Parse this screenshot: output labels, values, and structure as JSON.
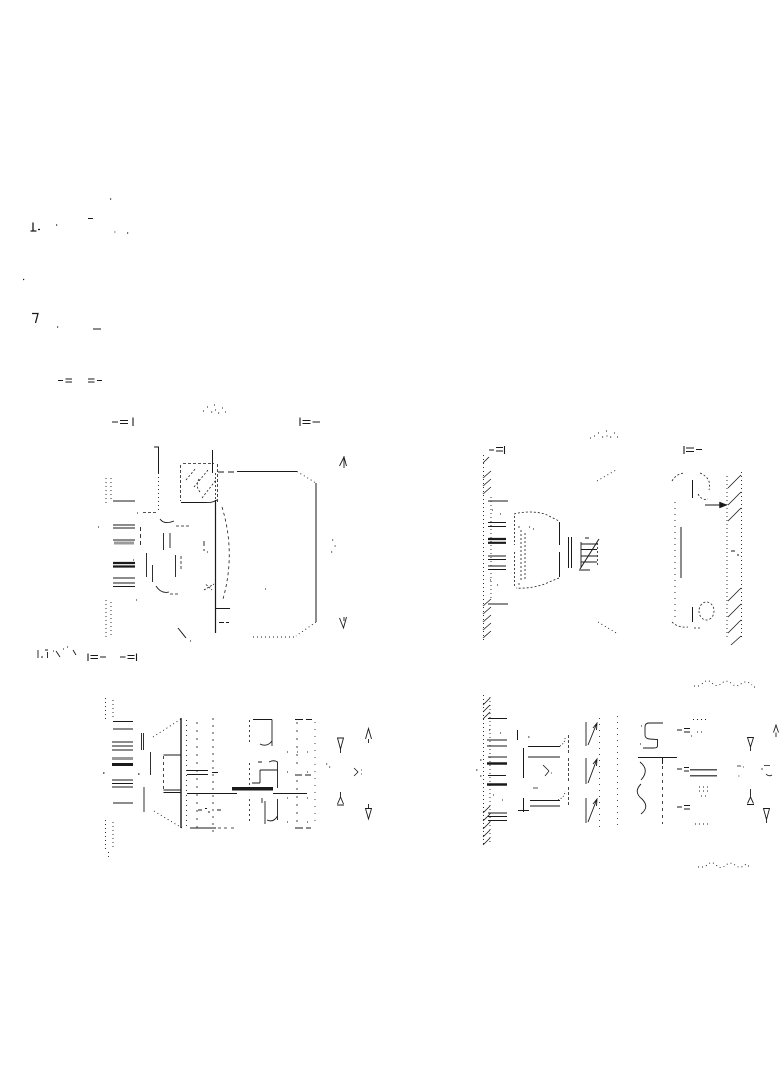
{
  "page": {
    "background": "#ffffff",
    "ink": "#1a1a1a",
    "accent_gray": "#9a9a9a"
  },
  "views": [
    {
      "id": "view-a",
      "position": "upper-left",
      "kind": "section-view",
      "label_text_legible": false,
      "marker_left_glyph": "-=|",
      "marker_right_glyph": "|=-"
    },
    {
      "id": "view-b",
      "position": "upper-right",
      "kind": "section-view",
      "label_text_legible": false,
      "marker_left_glyph": "-=|",
      "marker_right_glyph": "|=-"
    },
    {
      "id": "view-c",
      "position": "lower-left",
      "kind": "section-view",
      "marker_left_glyph": "|=-",
      "marker_right_glyph": "-=|"
    },
    {
      "id": "view-d",
      "position": "lower-right",
      "kind": "section-view"
    }
  ],
  "drawing": {
    "ink": "#1a1a1a",
    "groups": [
      {
        "name": "margin-marks",
        "strokes": [
          {
            "d": "M33 222.5 V231 M30.5 231 H36.5 M32 313.5 H38 L35.5 323",
            "w": 1.3
          },
          {
            "d": "M56 225 h1.2 M110 199 h1.2 M23 279.5 h1.2 M57 327 h1.2 M127 233 h1.2 M38 229.5 h2",
            "w": 1.2
          },
          {
            "d": "M88 218.5 H93 M93 329 H101",
            "w": 1
          },
          {
            "d": "M114 232 h1.5",
            "w": 1.4,
            "c": "#9a9a9a"
          },
          {
            "d": "M58 380.5 H63 M65.5 379 H72 M65.5 382 H72 M88 379 H94.5 M88 382 H94.5 M97 380.5 H102",
            "w": 1.1
          }
        ]
      },
      {
        "name": "view-a-label",
        "strokes": [
          {
            "d": "M203 411 h1 M207 407 h1 M211 412 h1.2 M214 405 h1 M215 410 h1 M218 413 h1.2 M222 408 h1 M225 412 h1",
            "w": 1.1
          }
        ]
      },
      {
        "name": "view-a-markers",
        "strokes": [
          {
            "d": "M112 422 H118 M120 420.5 H128 M120 423.5 H128 M133 417.5 V426",
            "w": 1.1
          },
          {
            "d": "M300 417.5 V426 M302.5 420.5 H310.5 M302.5 423.5 H310.5 M312.5 422 H320",
            "w": 1.1
          }
        ]
      },
      {
        "name": "view-a-body",
        "strokes": [
          {
            "d": "M106 478 V505 M111 478 V502 M106 600 V640 M111 602 V638",
            "dash": "1 3",
            "w": 0.9
          },
          {
            "d": "M113 501 H135 M113 525 H135 M113 528 H135 M113 540 H135 M113 578 H135 M113 583 H135 M113 586.5 H135",
            "w": 1
          },
          {
            "d": "M114 543 H134",
            "w": 3,
            "c": "#9a9a9a"
          },
          {
            "d": "M113 563 H135 M113 566.5 H135",
            "w": 2.2
          },
          {
            "d": "M140.5 527 V547",
            "dash": "4 3",
            "w": 0.9
          },
          {
            "d": "M158.5 447 V473 M154 447 H159 M212.5 450 V473",
            "w": 1
          },
          {
            "d": "M158.5 473 V510",
            "dash": "1 3",
            "w": 0.9
          },
          {
            "d": "M143 512.5 H158 M176 526 H189 M170 594 H178 M181 556 V570",
            "dash": "3 2",
            "w": 0.8
          },
          {
            "d": "M160 519 Q164 525 174 521 M156 586 Q161 594 169 592",
            "w": 0.9
          },
          {
            "d": "M163.5 533 V550 M170 533 V548 M175.5 555 V577 M146.5 553 V577 M152.5 565 V582",
            "w": 0.9
          },
          {
            "d": "M183 463.5 H214 M180.5 465 V501 M217.5 464 V502",
            "dash": "3 2",
            "w": 0.8
          },
          {
            "d": "M181 502.5 H206 M206 502.5 Q212 503 217 500",
            "w": 0.9
          },
          {
            "d": "M186 480 L196 468 M194 487 L208 470 M202 498 L216 480 M199 479 Q195 486 200 492",
            "dash": "2 2",
            "w": 0.8
          },
          {
            "d": "M215.5 473 V500",
            "dash": "2 2",
            "w": 0.8
          },
          {
            "d": "M215.5 500 V633",
            "w": 1.2
          },
          {
            "d": "M222 507 Q236 553 223 599",
            "dash": "3 3",
            "w": 0.8
          },
          {
            "d": "M204 541 v5 M204 549 v2 M207 552 h1",
            "w": 0.9
          },
          {
            "d": "M204 590 L214 584 M206 584.5 L212 590",
            "dash": "2 1.5",
            "w": 0.8
          },
          {
            "d": "M215 608.5 H230 M178 628 L186 638",
            "w": 1
          },
          {
            "d": "M219 622.5 H224 M226 622.5 H229 M218 472 H224 M228 472 H234",
            "w": 0.9
          },
          {
            "d": "M237 471.5 H297 M316 483 V622",
            "w": 1
          },
          {
            "d": "M297 471.5 L316 483 M316 622 L296 636 M294 637 H253",
            "dash": "1 3",
            "w": 0.9
          },
          {
            "d": "M137 513 h1 M133 560 h1 M136 600 h1 M98 527 h1 M190 641 h1 M265 589 h1",
            "w": 1.1
          },
          {
            "d": "M332 540 h1.2 M334.5 546 h1.2 M331 552 h1.2",
            "w": 1.1
          },
          {
            "d": "M344 456 V468 M339.5 466 L344 457 L346.5 466",
            "w": 0.9
          },
          {
            "d": "M344 617 V621 M339.5 618 L343.5 628 L346.5 617",
            "w": 0.9
          }
        ]
      },
      {
        "name": "view-b-label",
        "strokes": [
          {
            "d": "M590 438 h1 M594 436 h1 M598 433 h1 M602 437 h1.2 M606 431 h1 M606.5 436 h1 M610 437 h1.2 M614 433 h1 M617 437 h1",
            "w": 1.1
          }
        ]
      },
      {
        "name": "view-b-markers",
        "strokes": [
          {
            "d": "M489 450 H494 M496 447.5 H503 M496 451 H503 M504.5 446 V454",
            "w": 1.1
          },
          {
            "d": "M684 446 V454 M686 448 H694 M686 451.5 H694 M696 449.5 H702",
            "w": 1.1
          }
        ]
      },
      {
        "name": "view-b-body",
        "strokes": [
          {
            "d": "M483.5 455 V642 M491 497 V598",
            "dash": "1 3",
            "w": 0.9
          },
          {
            "d": "M483 463 L489 457 M483 478 L491 471 M483 486 L491 479 M483 494 L491 487 M483 606 L491 599 M483 614 L491 607 M483 622 L491 615 M483 630 L491 623 M483 638 L491 631",
            "w": 0.8
          },
          {
            "d": "M488 501 H508 M488 604 H508",
            "w": 1
          },
          {
            "d": "M488 522.5 H506 M488 526.5 H506 M488 556 H506 M488 559.5 H506 M488 566 H506 M488 569.5 H506",
            "w": 1
          },
          {
            "d": "M488 539 H506 M488 542.8 H506",
            "w": 2.2
          },
          {
            "d": "M490 580 h1 M497 585 h1 M492 510 h1 M500 514 h1 M529 527 h1 M533 529 h1",
            "w": 1.1
          },
          {
            "d": "M514 514 Q530 510 545 514 L559 521 M559 578 L542 585 Q527 589 516 588 M514.5 516 V545 M514.5 552 V586 M521 530 V582 M525 533 V579 M518 527 H522 M518 584 H522",
            "dash": "2 2",
            "w": 0.8
          },
          {
            "d": "M559.5 522 V545 M559.5 552 V577 M568.5 537 V568 M571.5 537 V568",
            "w": 1
          },
          {
            "d": "M581 544 H597 M581 549.5 H597 M581 556 H597 M581 562 H597 M581 542 V568 M579 570 H590 M585 538 H589",
            "w": 0.9
          },
          {
            "d": "M597.5 543 V566",
            "dash": "2 2",
            "w": 0.8
          },
          {
            "d": "M580 569 L599 539",
            "w": 1
          },
          {
            "d": "M597 481 L616 470 M598 622 L618 634",
            "dash": "1 3",
            "w": 0.9
          },
          {
            "d": "M672 481 Q676 474 684 473 M700 473 Q712 478 709 490 M698 494 Q702 501 708 499 M672 622 Q678 628 688 627 M694 628 H702",
            "dash": "2 2",
            "w": 0.8
          },
          {
            "d": "M699 611 a7.5 9 0 1 0 15 0 a7.5 9 0 1 0 -15 0",
            "dash": "2 2",
            "w": 0.8
          },
          {
            "d": "M692.5 480 V498 M692.5 607 V622 M681 527 V578",
            "w": 1
          },
          {
            "d": "M675 502 V622",
            "dash": "1 5",
            "w": 0.9
          },
          {
            "d": "M705 505 H721",
            "w": 1
          },
          {
            "d": "M727 505 L719.5 502 L719.5 508 Z",
            "f": "#1a1a1a",
            "w": 0.5
          },
          {
            "d": "M727 476 V640 M741.5 472 V640",
            "dash": "1 3",
            "w": 0.9
          },
          {
            "d": "M728 488 L741 475 M728 505 L741 492 M728 521 L741 508 M728 601 L741 588 M728 617 L741 604 M728 633 L741 620 M731 645 L741 636",
            "w": 0.8
          },
          {
            "d": "M731 551 h4 M737 555 h2",
            "w": 0.9
          }
        ]
      },
      {
        "name": "view-c-corner-text",
        "strokes": [
          {
            "d": "M38 650 V658 M41 657 H43 M45 650 H48 M47.5 652 V658 M53 651 h1 M56 651 L60 657 M63 649 h1 M67 647 h1 M73 650 l3 5",
            "w": 0.9
          }
        ]
      },
      {
        "name": "view-c-markers",
        "strokes": [
          {
            "d": "M88 653.5 V661 M90.5 655.5 H98 M90.5 658.5 H98 M100 657 H106",
            "w": 1.1
          },
          {
            "d": "M120 657 H125.5 M127.5 655.5 H134.5 M127.5 658.5 H134.5 M136.5 653.5 V661",
            "w": 1.1
          }
        ]
      },
      {
        "name": "view-c-body",
        "strokes": [
          {
            "d": "M105.5 698 V722 M113 700 V720 M105.5 820 V850 M113 822 V848 M108.5 852 V858",
            "dash": "1 3",
            "w": 0.9
          },
          {
            "d": "M113 721.5 H133 M113 729 H133 M112 742 H133 M112 746 H133 M112 750 H133 M112 780 H133 M112 783.5 H133 M112 787 H133 M113 803 H133",
            "w": 1
          },
          {
            "d": "M112 758.5 H133",
            "w": 3,
            "c": "#9a9a9a"
          },
          {
            "d": "M112 764.5 H133",
            "w": 3
          },
          {
            "d": "M103 773 h1.5 M138 774 h1.5",
            "w": 1.2
          },
          {
            "d": "M141.5 733 V750 M143.5 733 V750 M150.5 752 V775 M144 787 V812",
            "w": 0.9
          },
          {
            "d": "M153 737 L181 719 M154 811 L182 828",
            "dash": "1 3",
            "w": 0.9
          },
          {
            "d": "M181 718 V828",
            "w": 1.4
          },
          {
            "d": "M163.5 755 H181 M163.5 790 H181 M163.5 792.5 H181",
            "w": 0.9
          },
          {
            "d": "M163.5 756 V789",
            "dash": "3 3",
            "w": 0.8
          },
          {
            "d": "M186.5 720 V827",
            "dash": "1 4",
            "w": 0.9
          },
          {
            "d": "M197 722 V830",
            "dash": "2 6",
            "w": 0.8
          },
          {
            "d": "M213 718 V833",
            "dash": "2 5",
            "w": 0.8
          },
          {
            "d": "M187 770.5 H208 M187 774.5 H208 M212 772.5 H218",
            "w": 1
          },
          {
            "d": "M187 793.5 H237 M273 793.5 H307",
            "w": 1
          },
          {
            "d": "M232 788.8 H273",
            "w": 3.5
          },
          {
            "d": "M253 719.5 H272 M272 719.5 V746 M272 741 Q267 747.5 260 744",
            "w": 0.9
          },
          {
            "d": "M252 783 H260 M260 783 V770 M260 770 H277.5 M277.5 788 V762 Q274 759.5 269 762",
            "w": 0.9
          },
          {
            "d": "M277.5 799 V820 M277.5 816 Q273.5 823 267 820 M262 798 V803 M265 801 V824",
            "w": 0.9
          },
          {
            "d": "M249.5 720 V744 M249.5 763 V785 M249.5 799 V821",
            "dash": "2 3",
            "w": 0.8
          },
          {
            "d": "M198 810 H202 M205 808.5 h2 M208 812 h2 M217 810 h4 M258 762 h4",
            "w": 0.9
          },
          {
            "d": "M190 828 H216",
            "w": 1
          },
          {
            "d": "M218 828 h3 M224 828 h3 M231 828 h3",
            "w": 0.8
          },
          {
            "d": "M295 719.5 h8 M306 719.5 h6 M295 775 h7 M305 775 h6 M295 828 h8 M306 828 h5",
            "w": 0.9
          },
          {
            "d": "M297 722 V770 M297 780 V826",
            "dash": "2 6",
            "w": 0.8
          },
          {
            "d": "M315 722 V826",
            "dash": "1 6",
            "w": 0.8
          },
          {
            "d": "M287 752 h1 M297 752 h1 M307 752 h1 M287 772 h1 M307 772 h1 M287 798 h1 M307 798 h1 M287 822 h1 M307 822 h1 M326 764 h1.2 M329 767 h1.2",
            "w": 1.1
          },
          {
            "d": "M354 768 L358 772 L354 776 M361 770 h1 M361 774 h1",
            "w": 0.8
          },
          {
            "d": "M337.5 738 H343.5 L340.5 749 Z M340.5 749 V753",
            "w": 0.9
          },
          {
            "d": "M365.5 739 L368.5 728.5 L371.5 739 M368.5 739 V743",
            "w": 0.9
          },
          {
            "d": "M340.5 792 V797 M337.5 804 L340.5 797 L343.5 804 M337 805 H344",
            "w": 0.9
          },
          {
            "d": "M365.5 808.5 H371.5 L368.5 819 Z M368.5 804 V808.5",
            "w": 0.9
          }
        ]
      },
      {
        "name": "view-d-body",
        "strokes": [
          {
            "d": "M694 686 H700 M702 684 Q707 678 712 683 Q717 688 722 683 Q727 679 732 684 Q737 688 742 683 Q747 680 752 685 M754 687 h3",
            "dash": "1 3",
            "w": 0.9
          },
          {
            "d": "M698 867 H703 M706 866 Q711 860 716 865 Q721 870 726 865 Q731 861 736 866 Q741 869 746 864 M748 866 h4",
            "dash": "1 3",
            "w": 0.9
          },
          {
            "d": "M483.5 695 V845 M490 697 V843",
            "dash": "1 3",
            "w": 0.9
          },
          {
            "d": "M483 705 L490 698 M483 712 L490 705 M483 719 L490 712 M483 813 L490 806 M483 821 L490 814 M483 829 L490 822 M483 837 L490 830 M483 845 L490 838",
            "w": 0.8
          },
          {
            "d": "M488 718.5 H507 M487 740 H507 M487 746 H507 M488 757 H507 M488 775.5 H506 M488 813 H507 M488 816.5 H507 M488 820.5 H507",
            "w": 1
          },
          {
            "d": "M487 763.5 H507 M487 784.5 H507",
            "w": 2.5
          },
          {
            "d": "M489 730 h1 M500 733 h1 M493 795 h1 M502 800 h1 M476 770 h1.5 M480 760 h1.5 M480 776 h1.5",
            "w": 1.1
          },
          {
            "d": "M517.5 730 V740 M528 737 h1.5",
            "w": 1
          },
          {
            "d": "M523.5 748 V778 M523.5 798 V812 M518 810.5 H529",
            "w": 1
          },
          {
            "d": "M528 746.5 H560 M528 757 H560 M530 800.5 H560 M530 806 H560",
            "w": 1
          },
          {
            "d": "M560 746 Q565 743 565 738 M558 800 Q565 797 565 791",
            "dash": "1 2",
            "w": 0.9
          },
          {
            "d": "M568.5 735 V753 M568.5 758 V782 M568.5 787 V807",
            "dash": "3 2",
            "w": 0.8
          },
          {
            "d": "M543 765 L549 771 M549 771 L545 776 M551 773 h1 M533 788 h5",
            "w": 0.8
          },
          {
            "d": "M586 722 V746 M588 745 L597 723 M593 728 L597 723 L596.5 730",
            "w": 0.9
          },
          {
            "d": "M586 758 V784 M588 783 L597 759 M593 764 L597 759 L596.5 766",
            "w": 0.9
          },
          {
            "d": "M586 798 V823 M588 822 L597 799 M593 804 L597 799 L596.5 806",
            "w": 0.9
          },
          {
            "d": "M599.5 718 V828 M617.5 716 V830",
            "dash": "1 5",
            "w": 0.8
          },
          {
            "d": "M663 723 H649 Q645 723 645 727 V735 Q645 738.5 649.5 739 L657.5 739.5 V746 Q657.5 748 654 748 H643",
            "w": 0.9
          },
          {
            "d": "M641 726 h1 M640 744 h1",
            "w": 1
          },
          {
            "d": "M638 757.5 H677 M662.5 758 V764",
            "w": 1
          },
          {
            "d": "M640 762 Q650 770 641 780 M641 784 Q633 792 642 799 Q650 807 641 814",
            "w": 0.9
          },
          {
            "d": "M662.5 766 V824",
            "dash": "3 4",
            "w": 0.8
          },
          {
            "d": "M677 730 H682 M684 728.5 H690 M684 732 H690 M677 769 H682 M684 767.5 H689 M684 771 H689 M677 807 H682 M684 805.5 H690 M684 809 H690 M691 736 h1",
            "w": 0.9
          },
          {
            "d": "M690 769.8 H717 M690 775.8 H717",
            "w": 1.2
          },
          {
            "d": "M699 787 H709 M699 791 H709 M701 796 H708 M693 719.5 H708 M695 824 H710 M697 732 H705",
            "dash": "1 3",
            "w": 1
          },
          {
            "d": "M737 766 h4 M743 767 h1 M764 765.5 h6 M761 769 h2 M766 774 Q769 777 772 775",
            "w": 0.8
          },
          {
            "d": "M738 776 h1.5",
            "w": 1.3,
            "c": "#9a9a9a"
          },
          {
            "d": "M747.5 737.5 H753.5 L750.5 747 Z M750.5 747 V751",
            "w": 0.9
          },
          {
            "d": "M773.5 732.5 L776 725 L778.5 732.5 M776 732.5 V737",
            "w": 0.9
          },
          {
            "d": "M750.5 789 V797 M747.5 803.5 L750.5 797 L753.5 803.5 M747 804.5 H754",
            "w": 0.9
          },
          {
            "d": "M763.5 808.5 H769.5 L766.5 819.5 Z M766.5 819.5 V823",
            "w": 0.9
          }
        ]
      }
    ]
  }
}
